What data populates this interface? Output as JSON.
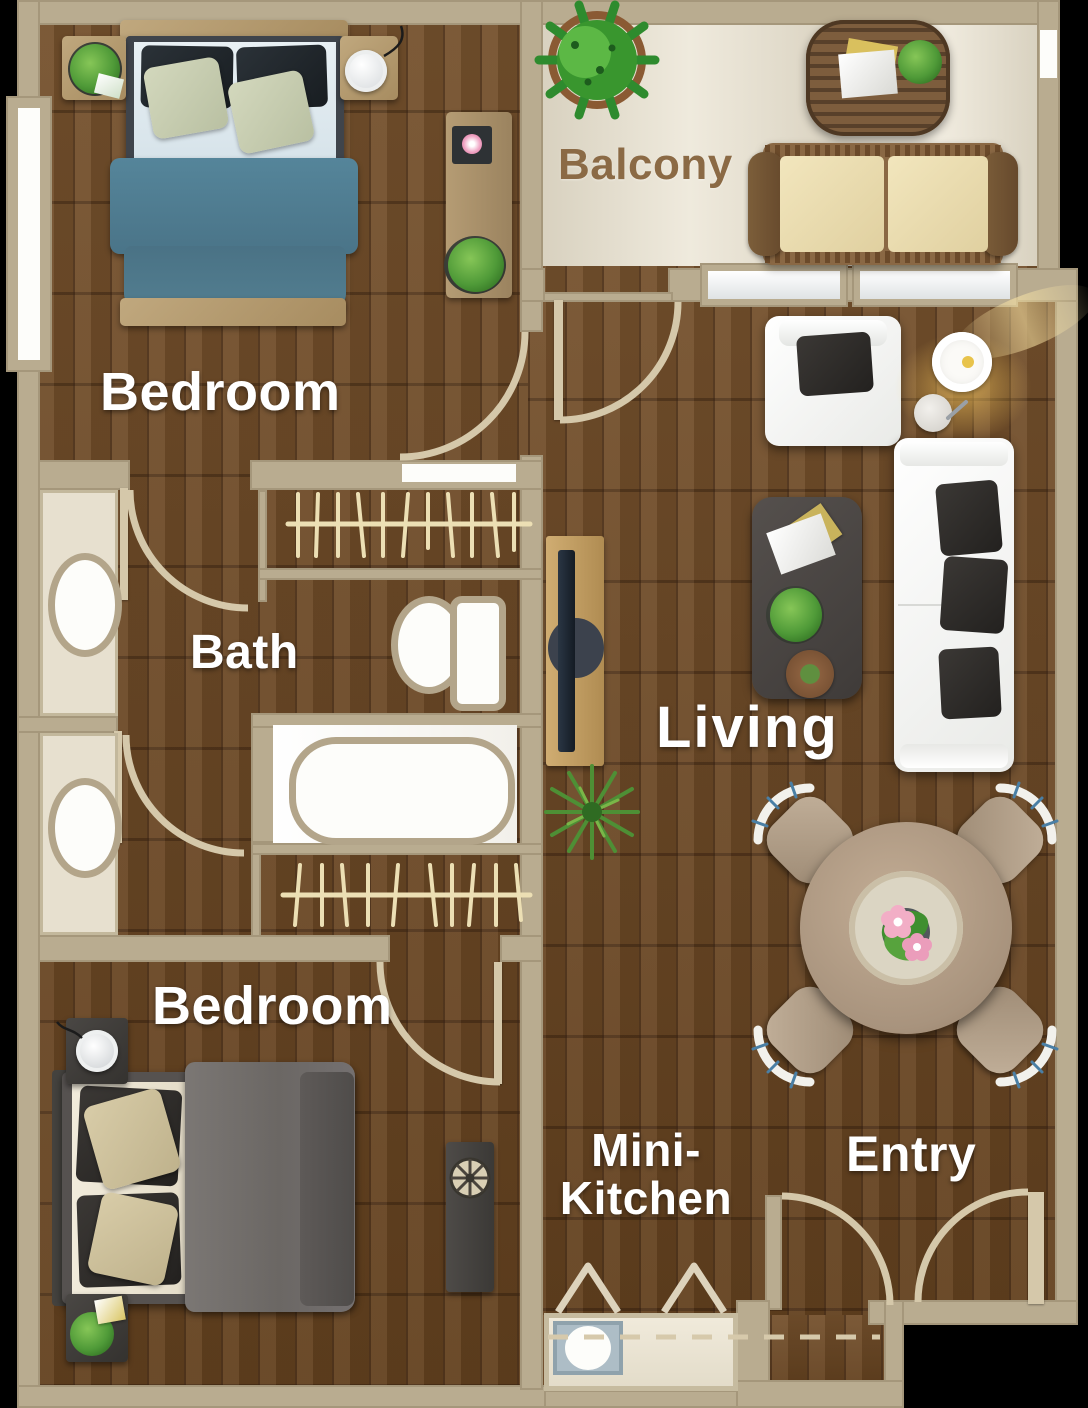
{
  "title": "Apartment Floor Plan",
  "rooms": {
    "bedroom_top": {
      "label": "Bedroom"
    },
    "balcony": {
      "label": "Balcony"
    },
    "bath": {
      "label": "Bath"
    },
    "living": {
      "label": "Living"
    },
    "bedroom_bottom": {
      "label": "Bedroom"
    },
    "mini_kitchen": {
      "label": "Mini-\nKitchen"
    },
    "entry": {
      "label": "Entry"
    }
  },
  "palette": {
    "background": "#000000",
    "wall_tan": "#b9ac90",
    "door_arc": "#d5c8aa",
    "wood_floor": "#6b4626",
    "balcony_floor": "#efeadd",
    "fixture_white": "#fdfdfa",
    "fixture_rim": "#b3a58a",
    "bed_top_duvet_teal": "#507d92",
    "bed_bottom_duvet_gray": "#6f6b68",
    "sofa_white": "#f3f4f2",
    "pillow_dark": "#34312e",
    "dining_table_wood": "#b49e88",
    "plant_green": "#4f9a38",
    "balcony_label_brown": "#8b6a45",
    "room_label_white": "#ffffff"
  },
  "furniture_icons": [
    "double-bed-icon",
    "nightstand-icon",
    "dresser-icon",
    "closet-hanger-icon",
    "sink-icon",
    "toilet-icon",
    "bathtub-icon",
    "tv-console-icon",
    "armchair-icon",
    "floor-lamp-icon",
    "sofa-icon",
    "coffee-table-icon",
    "dining-table-icon",
    "dining-chair-icon",
    "kitchen-counter-icon",
    "kitchen-sink-icon",
    "balcony-table-icon",
    "balcony-bench-icon",
    "potted-plant-icon",
    "door-swing-icon"
  ]
}
